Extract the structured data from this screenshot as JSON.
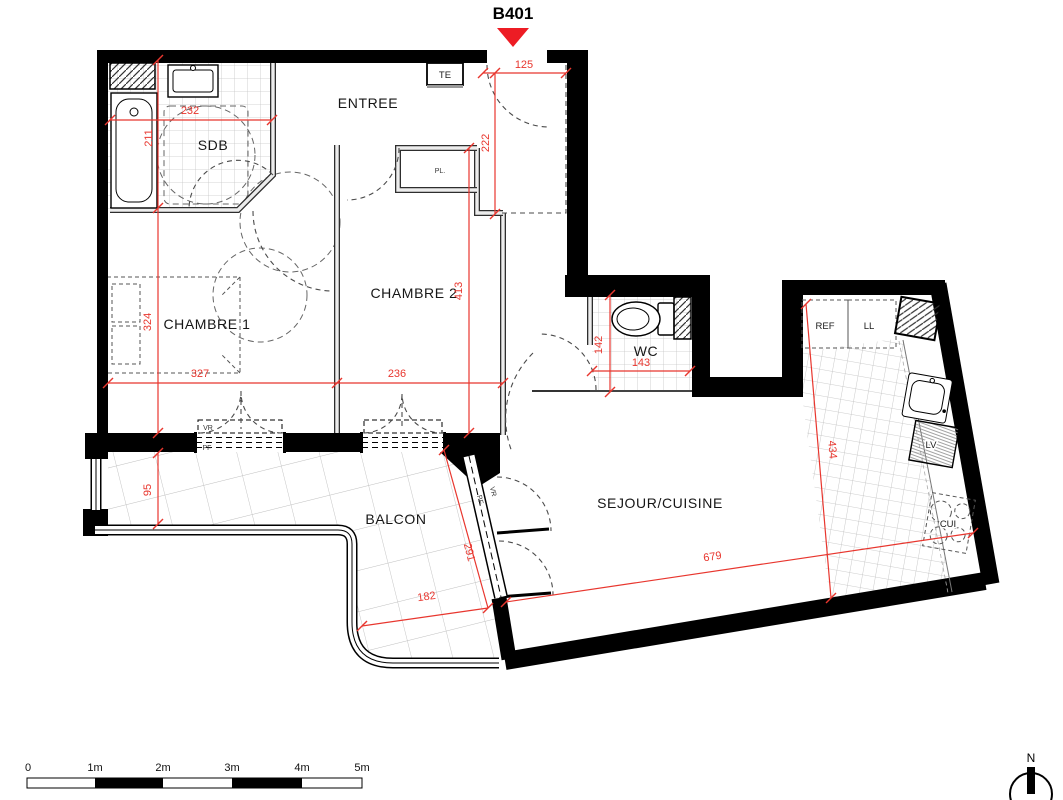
{
  "plan": {
    "unit": "B401",
    "rooms": {
      "entree": "ENTREE",
      "sdb": "SDB",
      "chambre1": "CHAMBRE 1",
      "chambre2": "CHAMBRE 2",
      "wc": "WC",
      "sejour": "SEJOUR/CUISINE",
      "balcon": "BALCON"
    },
    "closet": "PL.",
    "electrical_box": "TE",
    "appliances": {
      "fridge": "REF",
      "washer": "LL",
      "dishwasher": "LV",
      "hob": "CUI"
    },
    "windows": {
      "chambre1": {
        "shutter": "VR",
        "frame": "PF"
      },
      "sejour": {
        "shutter": "VR",
        "frame": "PF"
      }
    },
    "dimensions_cm": {
      "sdb_width": "232",
      "sdb_depth": "211",
      "entry_width": "125",
      "entry_depth": "222",
      "chambre2_depth": "413",
      "chambre1_depth": "324",
      "chambre1_width": "327",
      "chambre2_width": "236",
      "wc_depth": "142",
      "wc_width": "143",
      "balcon_depth": "95",
      "balcon_side": "291",
      "balcon_width": "182",
      "sejour_width": "679",
      "kitchen_depth": "434"
    },
    "scale_bar": {
      "labels": [
        "0",
        "1m",
        "2m",
        "3m",
        "4m",
        "5m"
      ]
    },
    "compass": {
      "north": "N"
    },
    "colors": {
      "wall": "#000000",
      "dimension_red": "#e8362e",
      "marker_red": "#ed1c24"
    }
  }
}
